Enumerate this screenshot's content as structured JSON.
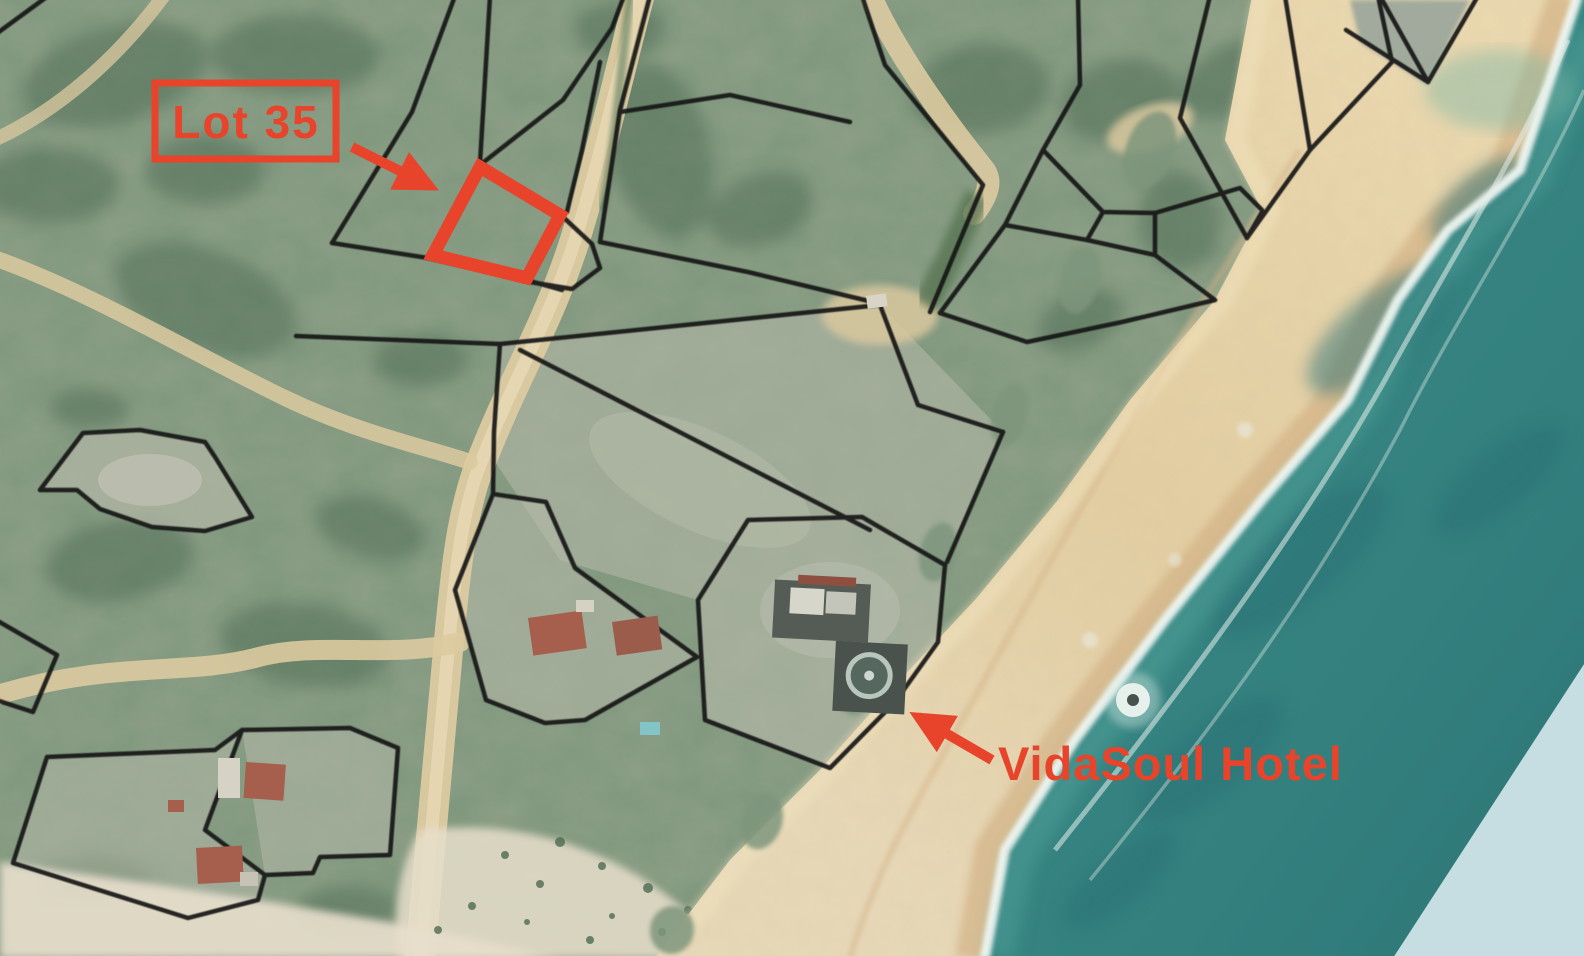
{
  "annotations": {
    "lot35": {
      "label": "Lot 35"
    },
    "hotel": {
      "label": "VidaSoul Hotel"
    }
  },
  "colors": {
    "annotation_red": "#e8432b",
    "boundary_black": "#161616",
    "ocean_teal": "#35817f",
    "ocean_deep": "#2c7476",
    "ocean_shore_turquoise": "#4aa099",
    "surf_white": "#edf4f0",
    "beach_sand": "#e6d2a6",
    "wet_sand": "#d3b286",
    "vegetation_green": "#8fa088",
    "scrub_dark_green": "#4e6b52",
    "cleared_lot_gray": "#b3b8a7",
    "road_sand": "#dccaa0",
    "building_roof_red": "#a55f4c",
    "building_roof_white": "#d8d5c8",
    "building_dark": "#4d544e",
    "no_data_pale_blue": "#c6dde2"
  }
}
